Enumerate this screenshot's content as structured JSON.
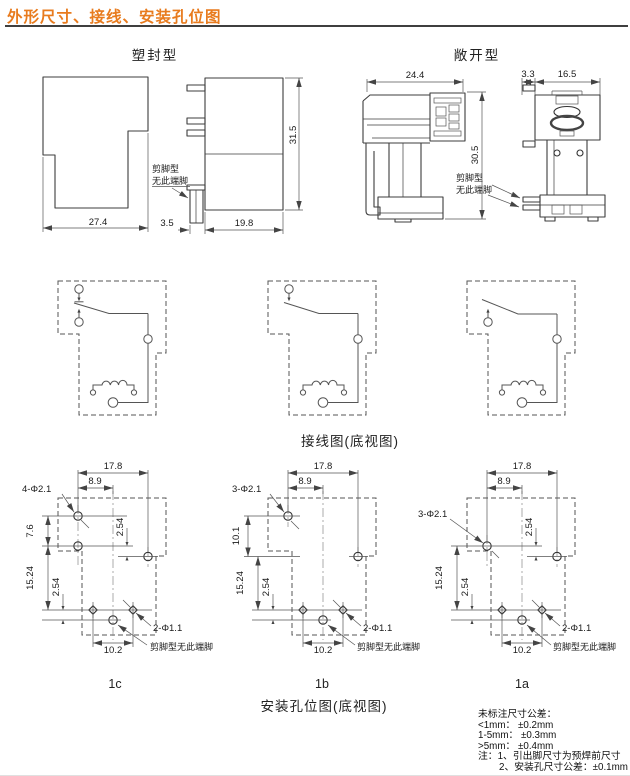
{
  "header": {
    "title": "外形尺寸、接线、安装孔位图"
  },
  "colors": {
    "accent": "#e87b1e",
    "rule": "#3f3f3f"
  },
  "sealed": {
    "label": "塑封型",
    "front": {
      "width": "27.4"
    },
    "side": {
      "pin_offset": "3.5",
      "depth": "19.8",
      "height": "31.5",
      "note1": "剪脚型",
      "note2": "无此端脚"
    }
  },
  "open": {
    "label": "敞开型",
    "front": {
      "width": "24.4",
      "height": "30.5"
    },
    "side": {
      "pin_offset": "3.3",
      "width": "16.5",
      "note1": "剪脚型",
      "note2": "无此端脚"
    }
  },
  "wiring": {
    "caption": "接线图(底视图)"
  },
  "mounting": {
    "caption": "安装孔位图(底视图)",
    "common": {
      "w_outer": "17.8",
      "w_inner": "8.9",
      "pitch_mid": "2.54",
      "pitch_v": "15.24",
      "pitch_bot": "2.54",
      "w_bottom": "10.2",
      "small_holes": "2-Φ1.1",
      "note": "剪脚型无此端脚"
    },
    "d1c": {
      "label": "1c",
      "holes": "4-Φ2.1",
      "v_pitch": "7.6"
    },
    "d1b": {
      "label": "1b",
      "holes": "3-Φ2.1",
      "v_pitch": "10.1"
    },
    "d1a": {
      "label": "1a",
      "holes": "3-Φ2.1"
    }
  },
  "tolerances": {
    "title": "未标注尺寸公差：",
    "rows": [
      "<1mm： ±0.2mm",
      "1-5mm： ±0.3mm",
      ">5mm： ±0.4mm"
    ],
    "extra1": "注：1、引出脚尺寸为预焊前尺寸",
    "extra2": "2、安装孔尺寸公差：±0.1mm"
  }
}
